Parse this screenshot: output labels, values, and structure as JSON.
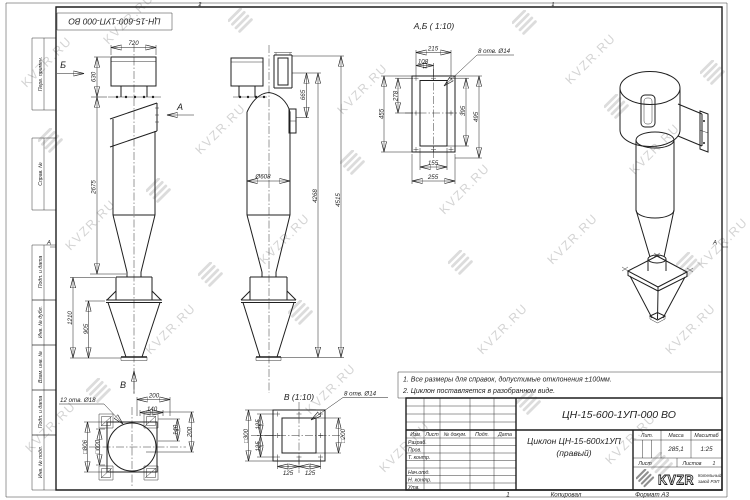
{
  "watermark": {
    "text": "KVZR.RU"
  },
  "sheet": {
    "stamp": "ЦН-15-600-1УП-000 ВО",
    "margin_labels": [
      "Перв. примен.",
      "Справ. №",
      "Подп. и дата",
      "Инв. № дубл.",
      "Взам. инв. №",
      "Подп. и дата",
      "Инв. № подл."
    ],
    "zone_marker_left": "А",
    "zone_marker_right": "А",
    "zone_top_left": "2",
    "zone_top_right": "1",
    "footer": {
      "num": "1",
      "copied": "Копировал",
      "format": "Формат А3"
    }
  },
  "notes": {
    "line1": "1. Все размеры для справок, допустимые отклонения ±100мм.",
    "line2": "2. Циклон поставляется в разобранном виде."
  },
  "views": {
    "front": {
      "dim_720": "720",
      "dim_630": "630",
      "dim_2675": "2675",
      "dim_1210": "1210",
      "dim_905": "905",
      "arrow_a": "А",
      "arrow_b": "Б",
      "arrow_v": "В"
    },
    "side": {
      "dim_665": "665",
      "dim_4268": "4268",
      "dim_4515": "4515",
      "dim_d608": "Ø608"
    },
    "section_ab": {
      "title": "А,Б ( 1:10)",
      "holes_note": "8 отв. Ø14",
      "dim_215": "215",
      "dim_108": "108",
      "dim_278": "278",
      "dim_455": "455",
      "dim_395": "395",
      "dim_495": "495",
      "dim_155": "155",
      "dim_255": "255"
    },
    "view_v": {
      "title": "В (1:10)",
      "holes_note": "8 отв. Ø14",
      "dim_s300": "□300",
      "dim_s200": "□200",
      "dim_125": "125"
    },
    "bottom_view": {
      "holes_note": "12 отв. Ø18",
      "dim_s806": "□806",
      "dim_s600": "□600",
      "dim_200t": "200",
      "dim_140t": "140",
      "dim_140r": "140",
      "dim_200r": "200"
    }
  },
  "title_block": {
    "doc_number": "ЦН-15-600-1УП-000 ВО",
    "name_line1": "Циклон ЦН-15-600х1УП",
    "name_line2": "(правый)",
    "col_izm": "Изм",
    "col_list": "Лист",
    "col_doc": "№ докум.",
    "col_podp": "Подп.",
    "col_data": "Дата",
    "row_razrab": "Разраб.",
    "row_prov": "Пров.",
    "row_tkontr": "Т. контр.",
    "row_nachotd": "Нач.отд.",
    "row_nkontr": "Н. контр.",
    "row_utv": "Утв.",
    "lit_label": "Лит.",
    "mass_label": "Масса",
    "mass_value": "285,1",
    "scale_label": "Масштаб",
    "scale_value": "1:25",
    "sheet_label": "Лист",
    "sheets_label": "Листов",
    "sheets_value": "1",
    "logo_text": "KVZR",
    "logo_sub1": "Котельный",
    "logo_sub2": "завод РЭП"
  },
  "colors": {
    "line": "#1f1f1f",
    "watermark": "#8f8f8f"
  }
}
